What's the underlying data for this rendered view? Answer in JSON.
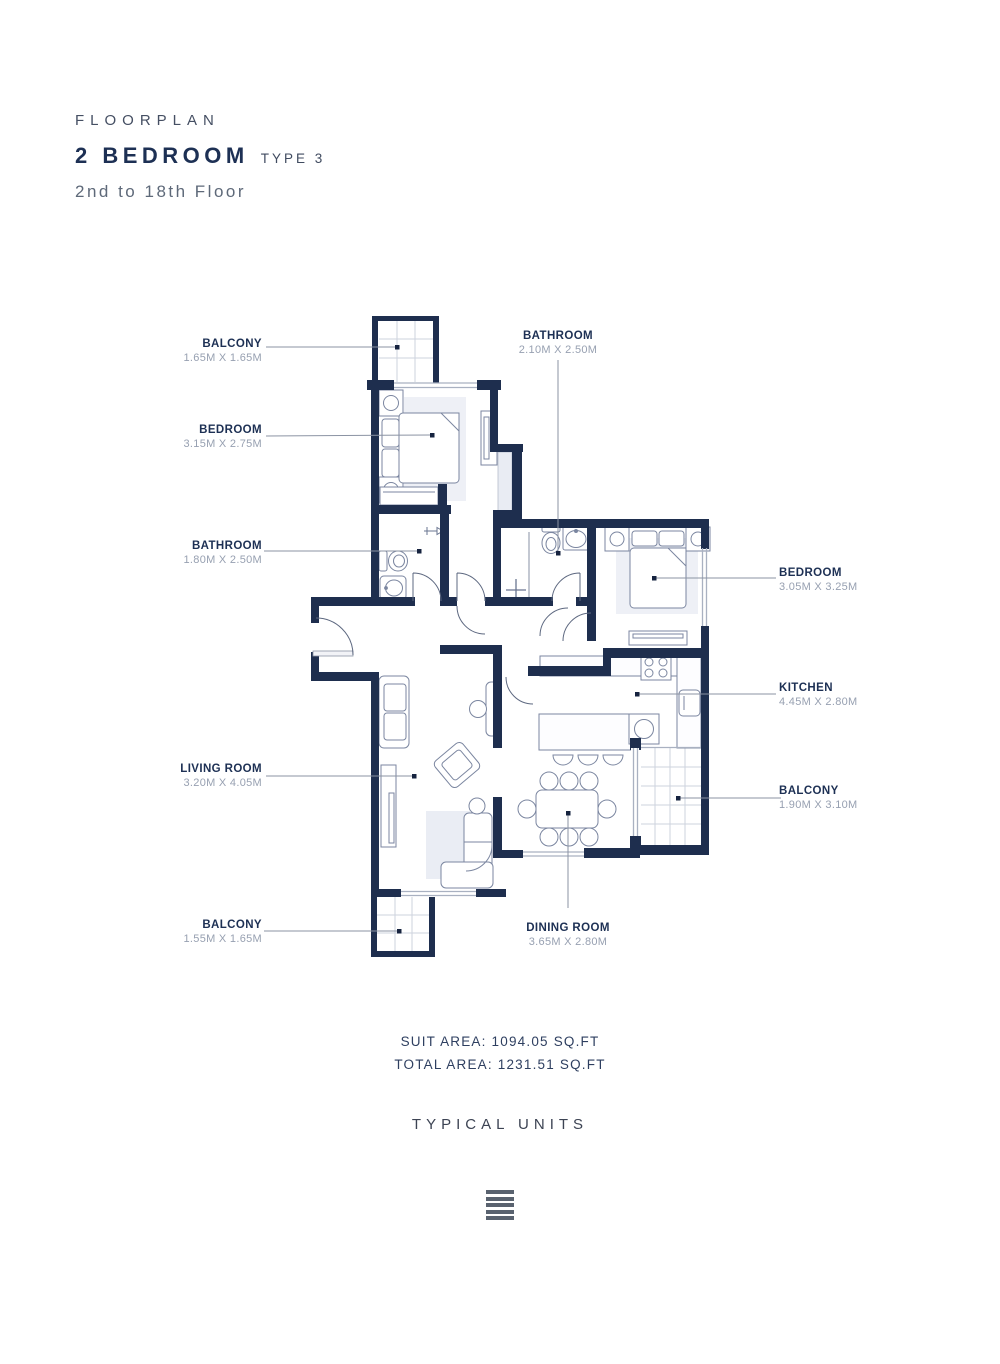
{
  "header": {
    "eyebrow": "FLOORPLAN",
    "title": "2 BEDROOM",
    "type": "TYPE 3",
    "floors": "2nd to 18th Floor"
  },
  "rooms": [
    {
      "id": "balcony-top",
      "name": "BALCONY",
      "dims": "1.65M X 1.65M"
    },
    {
      "id": "bathroom-top",
      "name": "BATHROOM",
      "dims": "2.10M X 2.50M"
    },
    {
      "id": "bedroom-1",
      "name": "BEDROOM",
      "dims": "3.15M X 2.75M"
    },
    {
      "id": "bathroom-1",
      "name": "BATHROOM",
      "dims": "1.80M X 2.50M"
    },
    {
      "id": "bedroom-2",
      "name": "BEDROOM",
      "dims": "3.05M X 3.25M"
    },
    {
      "id": "kitchen",
      "name": "KITCHEN",
      "dims": "4.45M X 2.80M"
    },
    {
      "id": "living-room",
      "name": "LIVING ROOM",
      "dims": "3.20M X 4.05M"
    },
    {
      "id": "balcony-right",
      "name": "BALCONY",
      "dims": "1.90M X 3.10M"
    },
    {
      "id": "balcony-bottom",
      "name": "BALCONY",
      "dims": "1.55M X 1.65M"
    },
    {
      "id": "dining-room",
      "name": "DINING ROOM",
      "dims": "3.65M X 2.80M"
    }
  ],
  "footer": {
    "suit_area": "SUIT AREA: 1094.05 SQ.FT",
    "total_area": "TOTAL AREA: 1231.51 SQ.FT",
    "typical_units": "TYPICAL UNITS",
    "logo_icon": "stacked-bars-logo"
  },
  "colors": {
    "wall": "#1e2e4e",
    "room_name": "#1d3054",
    "room_dims": "#97a0b1",
    "title": "#1d3054",
    "subtitle": "#5e6979",
    "leader": "#8b93a3"
  }
}
